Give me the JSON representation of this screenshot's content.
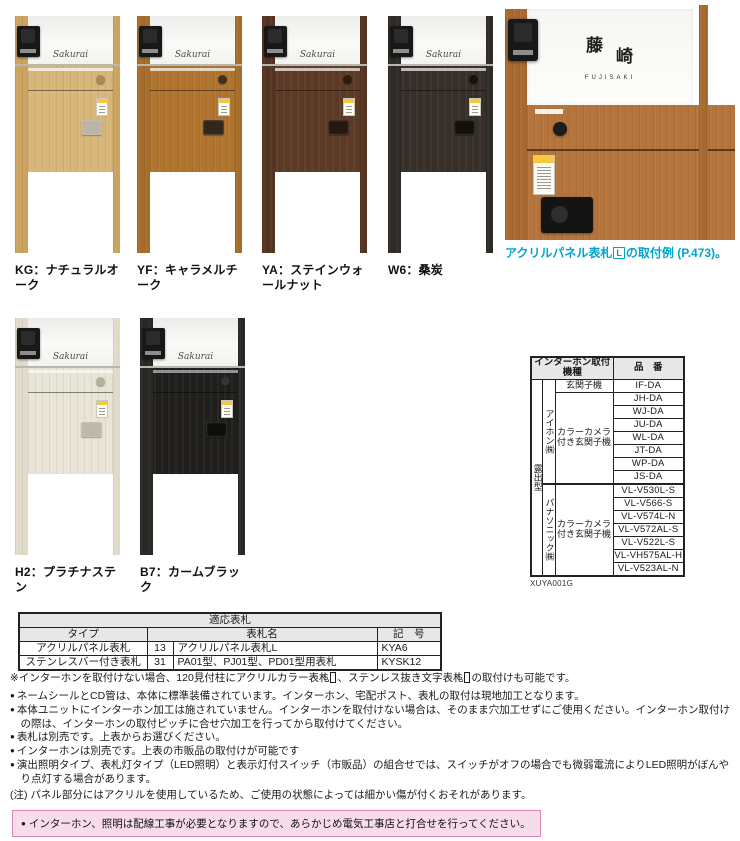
{
  "colors": {
    "accent_blue": "#00a4cc",
    "warning_bg": "#f9dcea",
    "warning_border": "#dd87b2",
    "table_header_bg": "#e7e7e7"
  },
  "products": {
    "signature": "Sakurai",
    "row1": [
      {
        "label": "KG：ナチュラルオーク",
        "body": "#d8b67a",
        "pillar": "#cba25e",
        "button": "#a88b50",
        "latch": "#bcb5a7",
        "slot": "#f2efe8"
      },
      {
        "label": "YF：キャラメルチーク",
        "body": "#b0742f",
        "pillar": "#a66c2a",
        "button": "#43301a",
        "latch": "#33261a",
        "slot": "#e8e0d2"
      },
      {
        "label": "YA：ステインウォールナット",
        "body": "#5d3a26",
        "pillar": "#543420",
        "button": "#2a1c12",
        "latch": "#241811",
        "slot": "#d8d2c8"
      },
      {
        "label": "W6：桑炭",
        "body": "#37302a",
        "pillar": "#2e2a25",
        "button": "#16130f",
        "latch": "#111008",
        "slot": "#cfcac2"
      }
    ],
    "row2": [
      {
        "label": "H2：プラチナステン",
        "body": "#e8e4d6",
        "pillar": "#e0dbc9",
        "button": "#b6b0a0",
        "latch": "#beb8a9",
        "slot": "#f7f5ef"
      },
      {
        "label": "B7：カームブラック",
        "body": "#201f1d",
        "pillar": "#292825",
        "button": "#35332f",
        "latch": "#0e0d0b",
        "slot": "#9b9fa3"
      }
    ]
  },
  "featured": {
    "kanji1": "藤",
    "kanji2": "崎",
    "roman": "FUJISAKI",
    "body": "#b4743c",
    "pillar": "#a86931",
    "button": "#1d1c1a",
    "device": "#141414",
    "caption_pre": "アクリルパネル表札",
    "caption_box": "L",
    "caption_post": "の取付例 (P.473)。"
  },
  "intercom_table": {
    "header_left": "インターホン取付機種",
    "header_right": "品　番",
    "mount_type": "露出型",
    "groups": [
      {
        "maker": "アイホン㈱",
        "sections": [
          {
            "label": "玄関子機",
            "models": [
              "IF-DA"
            ]
          },
          {
            "label": "カラーカメラ付き玄関子機",
            "models": [
              "JH-DA",
              "WJ-DA",
              "JU-DA",
              "WL-DA",
              "JT-DA",
              "WP-DA",
              "JS-DA"
            ]
          }
        ]
      },
      {
        "maker": "パナソニック㈱",
        "sections": [
          {
            "label": "カラーカメラ付き玄関子機",
            "models": [
              "VL-V530L-S",
              "VL-V566-S",
              "VL-V574L-N",
              "VL-V572AL-S",
              "VL-V522L-S",
              "VL-VH575AL-H",
              "VL-V523AL-N"
            ]
          }
        ]
      }
    ],
    "code": "XUYA001G"
  },
  "plate_table": {
    "title": "適応表札",
    "col_type": "タイプ",
    "col_name": "表札名",
    "col_code": "記　号",
    "rows": [
      {
        "type": "アクリルパネル表札",
        "num": "13",
        "name": "アクリルパネル表札L",
        "code": "KYA6"
      },
      {
        "type": "ステンレスバー付き表札",
        "num": "31",
        "name": "PA01型、PJ01型、PD01型用表札",
        "code": "KYSK12"
      }
    ]
  },
  "notes": {
    "asterisk": {
      "pre": "※インターホンを取付けない場合、120見付柱にアクリルカラー表札",
      "box1": "S",
      "mid": "、ステンレス抜き文字表札",
      "box2": "S",
      "post": "の取付けも可能です。"
    },
    "bullets": [
      "ネームシールとCD管は、本体に標準装備されています。インターホン、宅配ポスト、表札の取付は現地加工となります。",
      "本体ユニットにインターホン加工は施されていません。インターホンを取付けない場合は、そのまま穴加工せずにご使用ください。インターホン取付けの際は、インターホンの取付ピッチに合せ穴加工を行ってから取付けてください。",
      "表札は別売です。上表からお選びください。",
      "インターホンは別売です。上表の市販品の取付けが可能です",
      "演出照明タイプ、表札灯タイプ（LED照明）と表示灯付スイッチ（市販品）の組合せでは、スイッチがオフの場合でも微弱電流によりLED照明がぼんやり点灯する場合があります。"
    ],
    "caution": "(注) パネル部分にはアクリルを使用しているため、ご使用の状態によっては細かい傷が付くおそれがあります。",
    "warning": "インターホン、照明は配線工事が必要となりますので、あらかじめ電気工事店と打合せを行ってください。"
  }
}
